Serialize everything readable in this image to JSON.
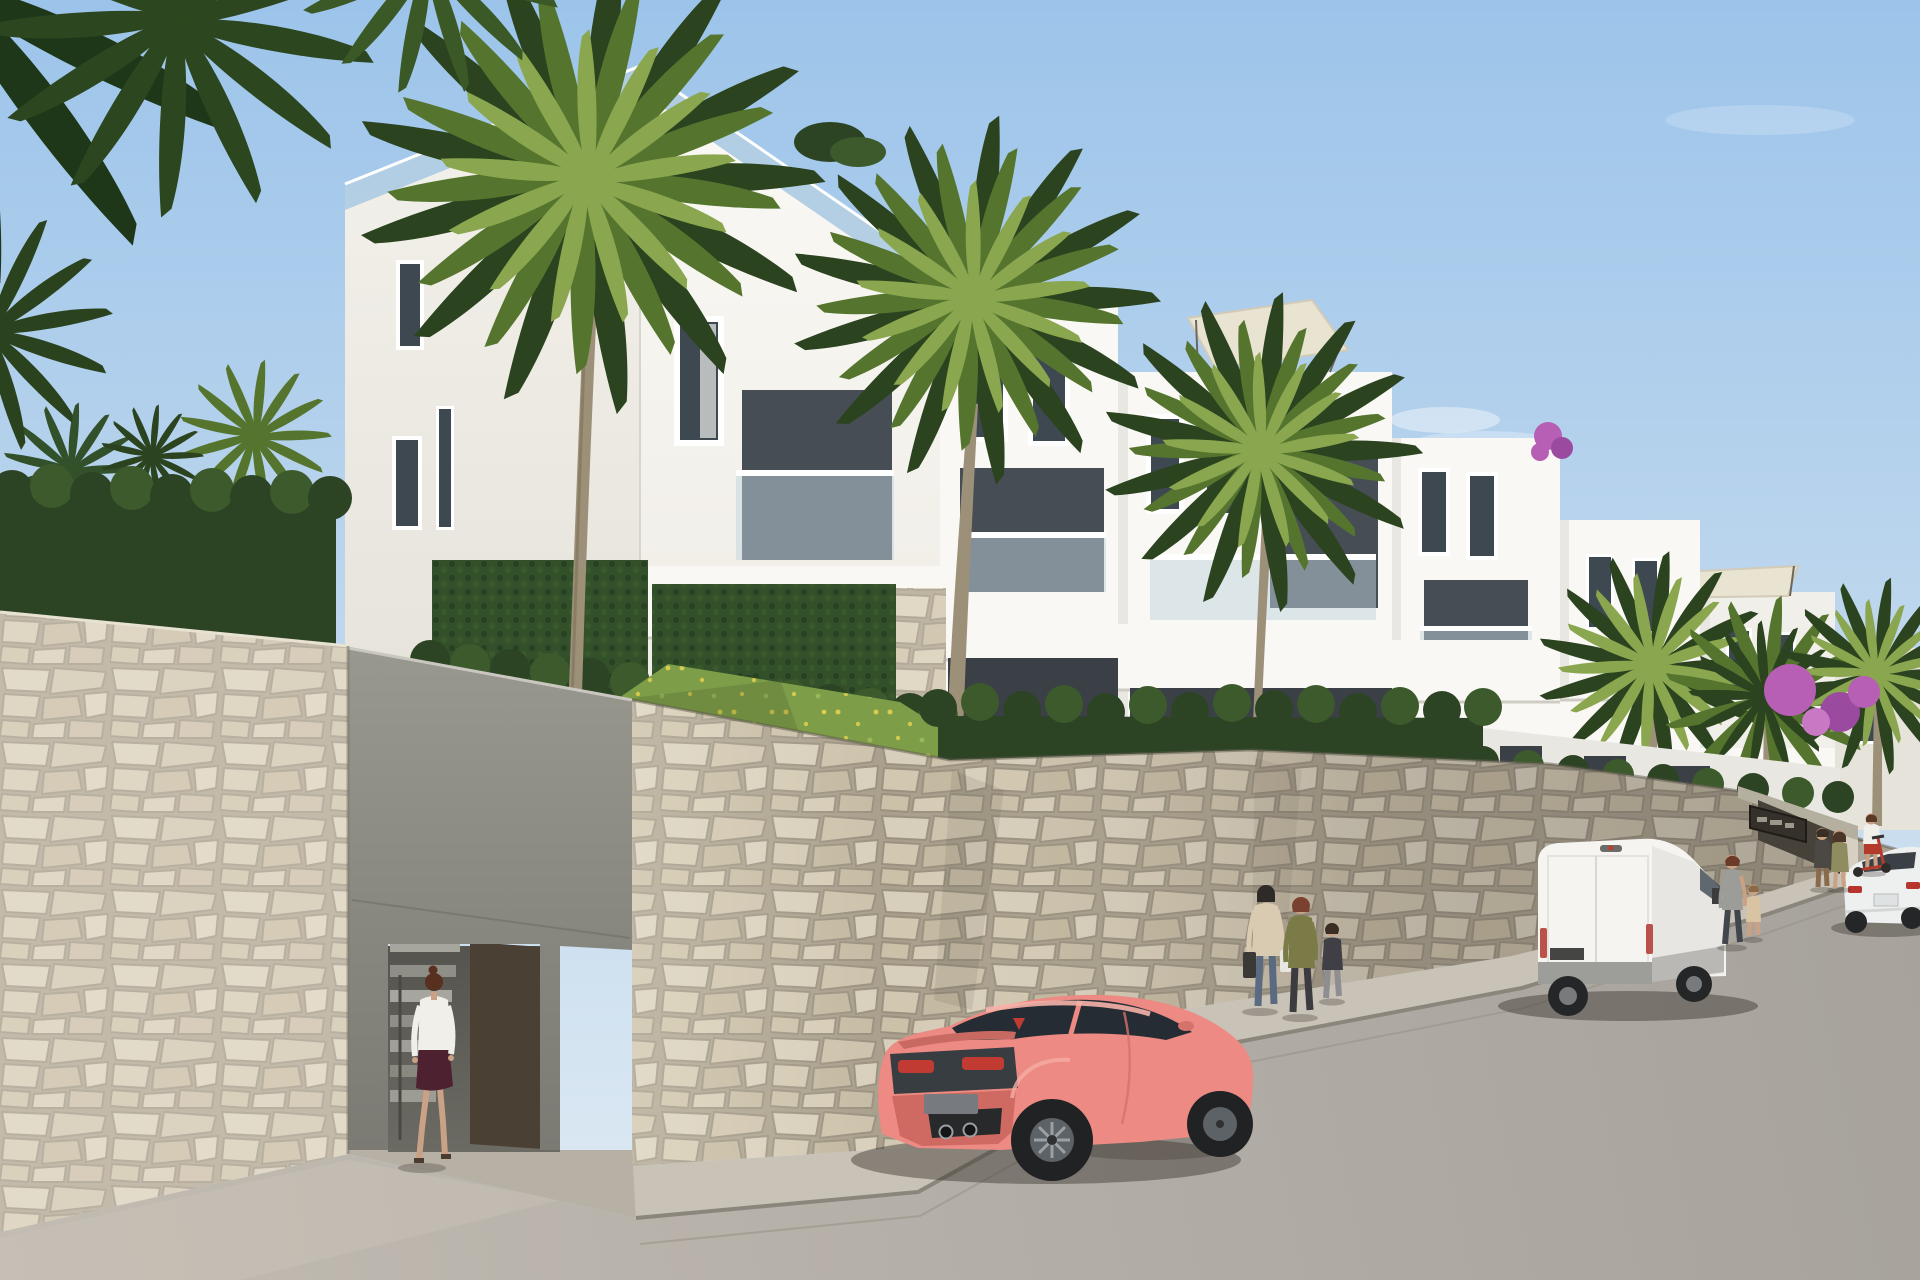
{
  "meta": {
    "title": "Architectural render: white hillside apartment complex, palm trees, stone retaining wall, street with parked pink coupe and white van"
  },
  "scene": {
    "setting": "new-build residential complex on a sloping street",
    "time_of_day": "bright clear daylight",
    "sky": "clear light blue with faint wisps of cloud"
  },
  "building": {
    "storeys_visible": 3,
    "style": "modern white cubic volumes stepping down the hill to the right",
    "features": [
      "roof terraces with glass railings",
      "cream shade sails on roof terraces",
      "recessed balconies with glass balustrades",
      "narrow vertical windows",
      "vertical ivy garden panels",
      "stone-clad planter pillars",
      "rooftop planting"
    ]
  },
  "landscape": {
    "palm_trees": 8,
    "overhanging_fronds": "dark palm fronds entering frame at top left",
    "hedges": "clipped dark green hedges along terrace edges",
    "grass": "sloped lawn dotted with small yellow wildflowers",
    "bougainvillea": "purple bougainvillea on right-hand terraces"
  },
  "walls": {
    "material": "cream and grey natural flagstone cladding",
    "left_entrance": {
      "type": "pedestrian stair entrance",
      "door": "open dark bronze gate panel",
      "stairs": "concrete steps leading up"
    },
    "right_entrance": {
      "type": "recessed community entrance",
      "plaque": "dark wall plaque with light lettering (not legible)"
    }
  },
  "street": {
    "road": "light grey asphalt rising to the right",
    "sidewalk": "raised walkway running along the stone wall"
  },
  "vehicles": [
    {
      "name": "pink-sports-car",
      "type": "sports coupe",
      "color_hex": "#ec8a83",
      "view": "rear three-quarter",
      "position": "parked centre foreground"
    },
    {
      "name": "white-van",
      "type": "panel van",
      "color_hex": "#f5f4f1",
      "view": "rear three-quarter",
      "position": "parked on the right, facing uphill"
    },
    {
      "name": "white-sedan",
      "type": "sedan",
      "color_hex": "#eef0ef",
      "position": "far right edge of frame"
    }
  ],
  "people": [
    {
      "name": "woman-entering-stairs",
      "clothing": "white blouse, dark plum skirt",
      "position": "left pedestrian entrance"
    },
    {
      "name": "woman-with-bags",
      "clothing": "beige top, blue jeans, carrying two bags",
      "position": "sidewalk centre-right"
    },
    {
      "name": "person-olive-jacket",
      "clothing": "olive jacket, dark trousers",
      "position": "sidewalk centre-right"
    },
    {
      "name": "child-grey-trousers",
      "clothing": "dark top, grey trousers",
      "position": "sidewalk centre-right"
    },
    {
      "name": "man-grey-tshirt",
      "clothing": "grey t-shirt, dark jeans",
      "position": "walking beside white van"
    },
    {
      "name": "toddler-beige",
      "clothing": "beige outfit",
      "position": "holding man's hand"
    },
    {
      "name": "man-dark-top",
      "clothing": "dark top, brown trousers",
      "position": "by far entrance"
    },
    {
      "name": "woman-olive-dress",
      "clothing": "olive dress",
      "position": "by far entrance"
    },
    {
      "name": "girl-with-scooter",
      "clothing": "white top, red shorts, red kick scooter",
      "position": "by far entrance"
    }
  ],
  "colors": {
    "sky_top": "#9cc4ea",
    "sky_mid": "#c2d9ee",
    "sky_low": "#e0ebf3",
    "white_sun": "#f9f8f4",
    "white_soft": "#f1efe9",
    "white_dim": "#e9e7e1",
    "white_far": "#e5e3da",
    "window_glass": "#3d4851",
    "recess": "#464d55",
    "loggia": "#3a4046",
    "balustrade": "#bfd4de",
    "stone_a": "#d6cdb8",
    "concrete": "#91908a",
    "hedge": "#2c4423",
    "hedge_light": "#3c5a2c",
    "ivy": "#32512b",
    "grass": "#7e9d49",
    "flower_yellow": "#e7d54e",
    "palm_dark": "#2b431f",
    "palm_mid": "#55752f",
    "palm_light": "#8aa64e",
    "trunk": "#9d9078",
    "road": "#b5b0a9",
    "sidewalk": "#c8c2b7",
    "curb": "#8b867c",
    "car_pink": "#ec8a83",
    "car_pink_hi": "#f7b2a9",
    "car_pink_sh": "#cf6a62",
    "car_glass": "#262c33",
    "tail_red": "#c23b33",
    "van_white": "#f5f4f1",
    "van_side": "#e7e6e2",
    "van_trim": "#9d9d99",
    "sedan": "#eef0ef",
    "door_brown": "#4b4034",
    "sign_bg": "#35312a",
    "sign_marks": "#b8b2a4",
    "sail": "#e9e3d2",
    "bougainvillea": "#b65fb4",
    "skin": "#c9a184"
  }
}
